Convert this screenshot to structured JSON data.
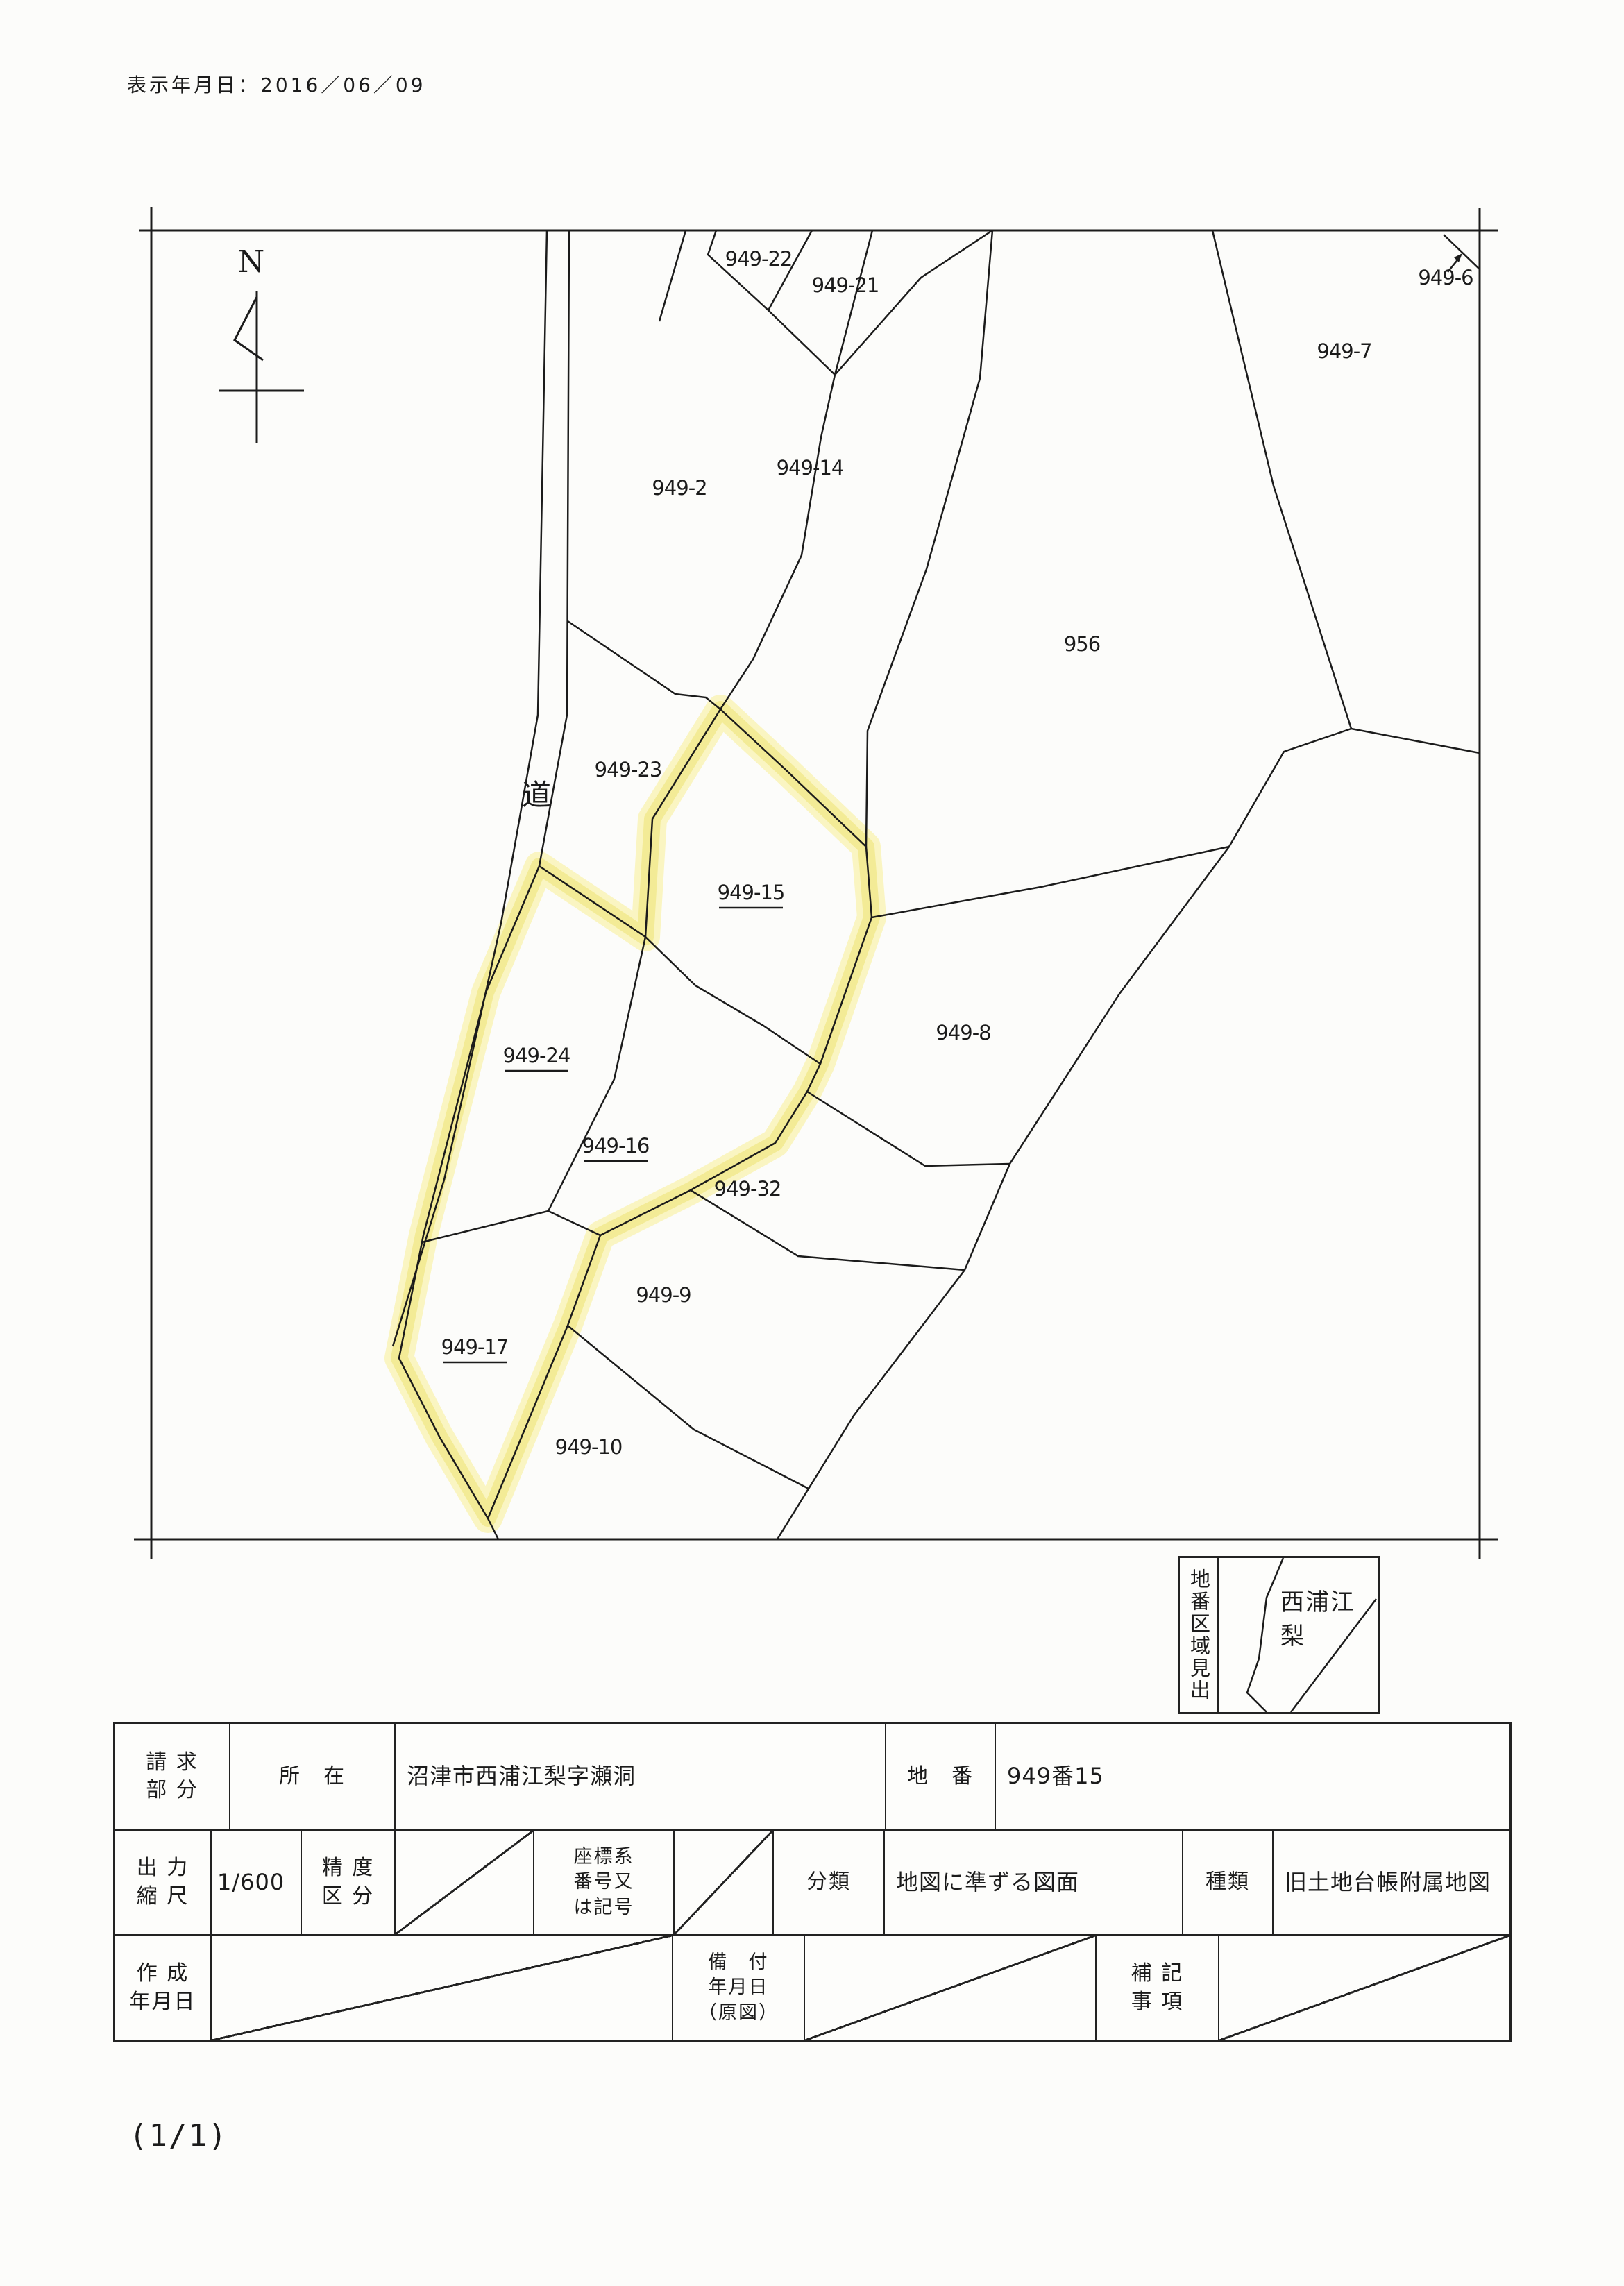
{
  "page": {
    "date_label": "表示年月日：2016／06／09",
    "page_indicator": "(1/1)"
  },
  "map": {
    "north_label": "N",
    "road_label": "道",
    "line_color": "#1b1b1b",
    "highlight_color": "#f3eb96",
    "parcels": [
      {
        "label": "949-22",
        "highlighted": false
      },
      {
        "label": "949-21",
        "highlighted": false
      },
      {
        "label": "949-6",
        "highlighted": false
      },
      {
        "label": "949-7",
        "highlighted": false
      },
      {
        "label": "949-2",
        "highlighted": false
      },
      {
        "label": "949-14",
        "highlighted": false
      },
      {
        "label": "956",
        "highlighted": false
      },
      {
        "label": "949-23",
        "highlighted": false
      },
      {
        "label": "949-15",
        "highlighted": true
      },
      {
        "label": "949-8",
        "highlighted": false
      },
      {
        "label": "949-24",
        "highlighted": true
      },
      {
        "label": "949-16",
        "highlighted": true
      },
      {
        "label": "949-32",
        "highlighted": false
      },
      {
        "label": "949-9",
        "highlighted": false
      },
      {
        "label": "949-17",
        "highlighted": true
      },
      {
        "label": "949-10",
        "highlighted": false
      }
    ]
  },
  "index_box": {
    "title": "地番区域見出",
    "area_label": "西浦江梨"
  },
  "table": {
    "request_part_label": "請 求\n部 分",
    "location_label": "所　在",
    "location_value": "沼津市西浦江梨字瀬洞",
    "lot_number_label": "地　番",
    "lot_number_value": "949番15",
    "scale_label": "出 力\n縮 尺",
    "scale_value": "1/600",
    "accuracy_label": "精 度\n区 分",
    "coord_label": "座標系\n番号又\nは記号",
    "class_label": "分類",
    "class_value": "地図に準ずる図面",
    "type_label": "種類",
    "type_value": "旧土地台帳附属地図",
    "created_label": "作 成\n年月日",
    "filed_label": "備　付\n年月日\n（原図）",
    "notes_label": "補 記\n事 項"
  }
}
